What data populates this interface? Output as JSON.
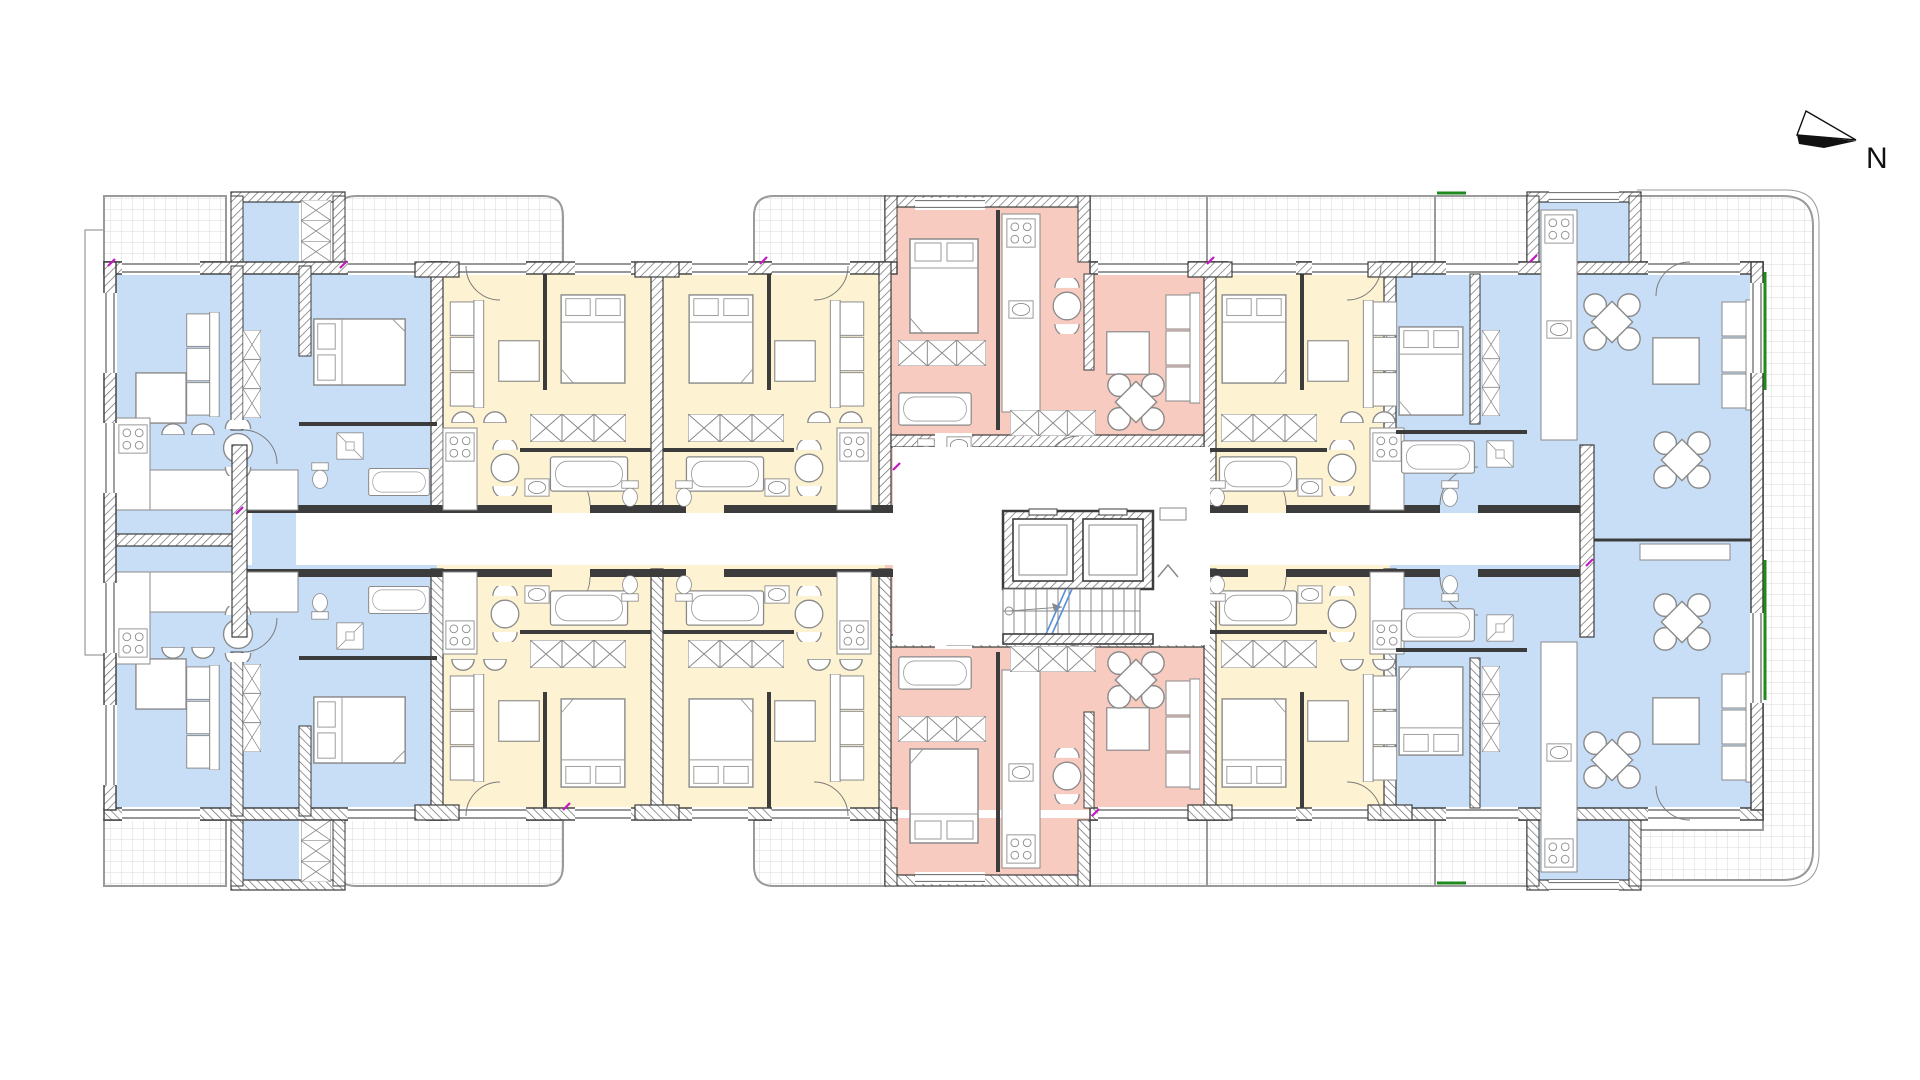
{
  "compass": {
    "label": "N"
  },
  "palette": {
    "unit_blue": "#c8def6",
    "unit_yellow": "#fdf3d2",
    "unit_pink": "#f8cbc1",
    "wall": "#3c3c3c",
    "line": "#7a7a7a",
    "furniture_line": "#8a8a8a",
    "balcony_grid": "#d9d9d9",
    "balcony_edge": "#9a9a9a",
    "accent_green": "#1f8a1f",
    "accent_magenta": "#c318c3",
    "stair_section_blue": "#5a8fd6",
    "floor_white": "#ffffff"
  },
  "units": [
    {
      "id": "west-end-upper",
      "color": "blue"
    },
    {
      "id": "west-end-lower",
      "color": "blue"
    },
    {
      "id": "mid-west-a-upper",
      "color": "yellow"
    },
    {
      "id": "mid-west-b-upper",
      "color": "yellow"
    },
    {
      "id": "mid-west-a-lower",
      "color": "yellow"
    },
    {
      "id": "mid-west-b-lower",
      "color": "yellow"
    },
    {
      "id": "center-upper",
      "color": "pink"
    },
    {
      "id": "center-lower",
      "color": "pink"
    },
    {
      "id": "mid-east-upper",
      "color": "yellow"
    },
    {
      "id": "mid-east-lower",
      "color": "yellow"
    },
    {
      "id": "east-end-upper",
      "color": "blue"
    },
    {
      "id": "east-end-lower",
      "color": "blue"
    }
  ],
  "core": {
    "elevator_shafts": 2,
    "staircase": true
  },
  "balconies": [
    "west-upper",
    "west-lower",
    "left-upper-rounded",
    "left-lower-rounded",
    "mid-left-upper",
    "mid-left-lower",
    "center-long-upper",
    "center-long-lower",
    "east-wrap-terrace"
  ]
}
